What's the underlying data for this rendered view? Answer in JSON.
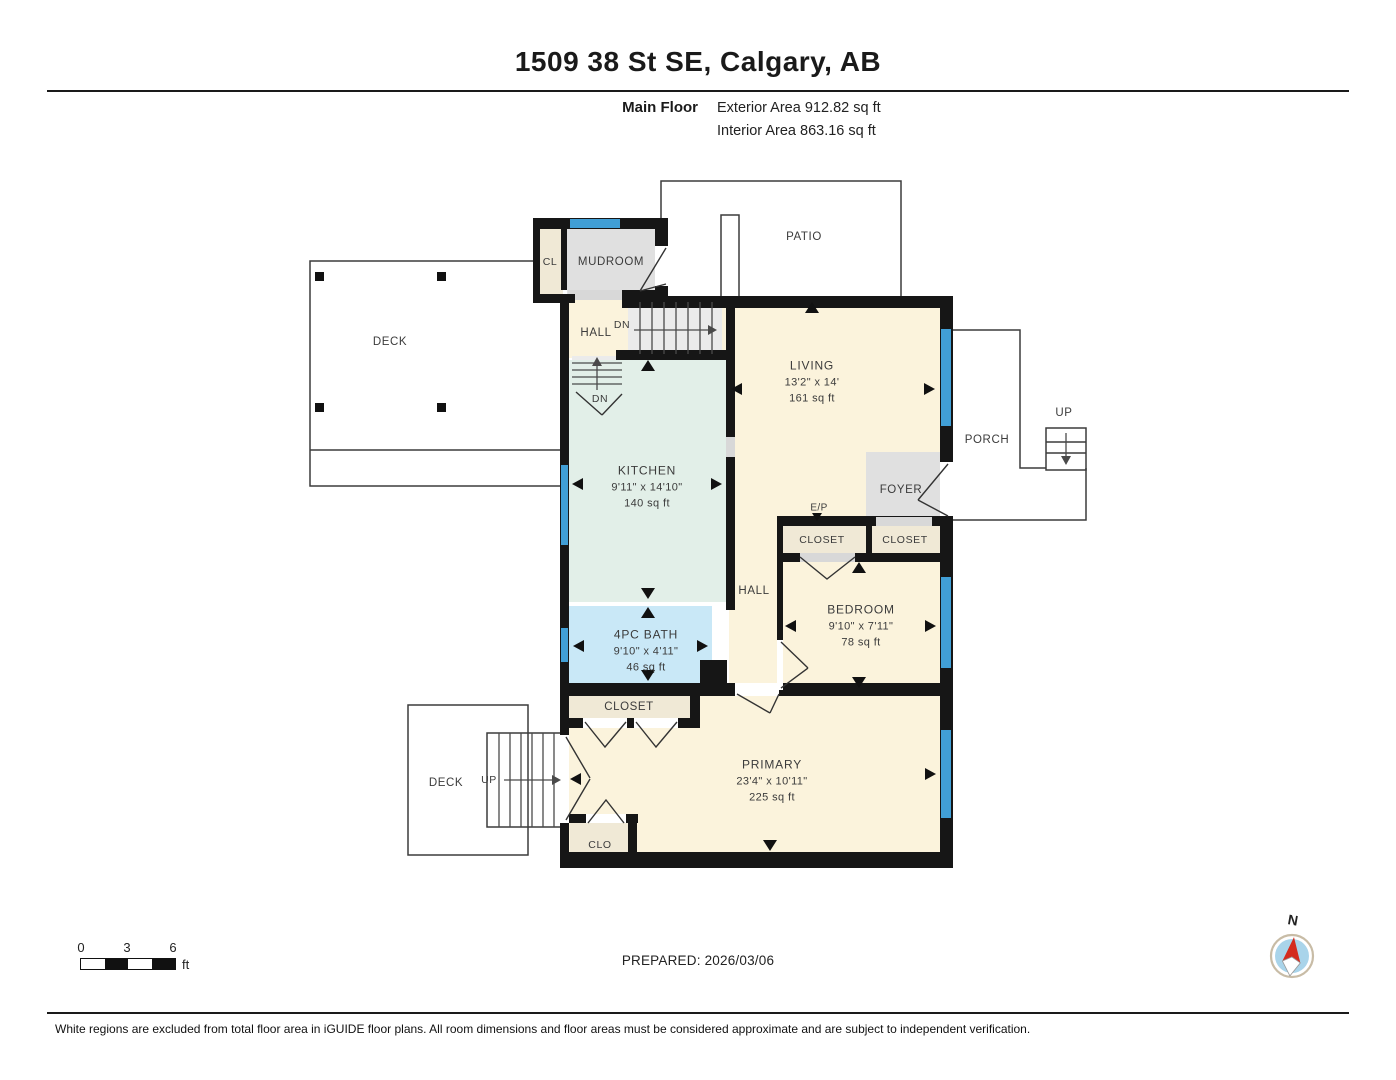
{
  "header": {
    "title": "1509 38 St SE, Calgary, AB",
    "floor_name": "Main Floor",
    "exterior_area": "Exterior Area 912.82 sq ft",
    "interior_area": "Interior Area 863.16 sq ft"
  },
  "rooms": {
    "living": {
      "name": "LIVING",
      "dims": "13'2\" x 14'",
      "area": "161 sq ft"
    },
    "kitchen": {
      "name": "KITCHEN",
      "dims": "9'11\" x 14'10\"",
      "area": "140 sq ft"
    },
    "bath": {
      "name": "4PC BATH",
      "dims": "9'10\" x 4'11\"",
      "area": "46 sq ft"
    },
    "bedroom": {
      "name": "BEDROOM",
      "dims": "9'10\" x 7'11\"",
      "area": "78 sq ft"
    },
    "primary": {
      "name": "PRIMARY",
      "dims": "23'4\" x 10'11\"",
      "area": "225 sq ft"
    }
  },
  "labels": {
    "patio": "PATIO",
    "deck_upper": "DECK",
    "deck_lower": "DECK",
    "porch": "PORCH",
    "mudroom": "MUDROOM",
    "foyer": "FOYER",
    "hall_upper": "HALL",
    "hall_lower": "HALL",
    "cl": "CL",
    "clo": "CLO",
    "closet_ep_left": "CLOSET",
    "closet_ep_right": "CLOSET",
    "closet_primary": "CLOSET",
    "ep": "E/P",
    "up_porch": "UP",
    "up_deck": "UP",
    "dn_stairs": "DN",
    "dn_basement": "DN"
  },
  "footer": {
    "scale_ticks": [
      "0",
      "3",
      "6"
    ],
    "scale_unit": "ft",
    "prepared": "PREPARED: 2026/03/06",
    "compass": "N",
    "disclaimer": "White regions are excluded from total floor area in iGUIDE floor plans. All room dimensions and floor areas must be considered approximate and are subject to independent verification."
  },
  "colors": {
    "room_cream": "#FBF3DC",
    "room_mint": "#E2EFE8",
    "room_bath_blue": "#C9E8F7",
    "room_gray": "#E0E0E0",
    "closet_beige": "#F0E9D6",
    "window_blue": "#419FD6",
    "wall_black": "#161616"
  }
}
